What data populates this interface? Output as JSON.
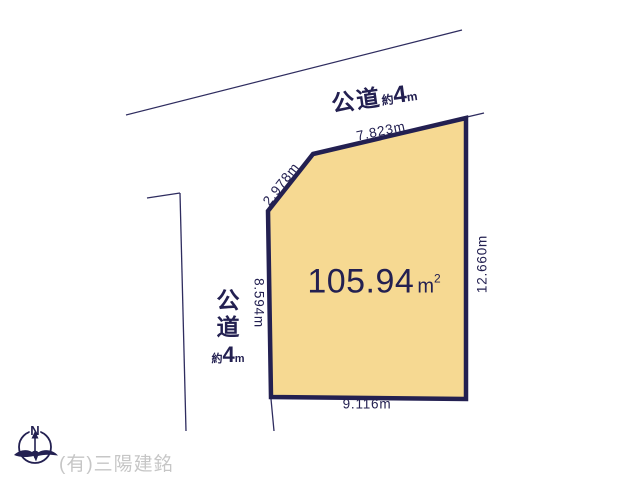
{
  "plot": {
    "area_value": "105.94",
    "area_unit": "m",
    "area_unit_sup": "2",
    "dim_top": "7.823m",
    "dim_diagonal": "2.978m",
    "dim_left": "8.594m",
    "dim_right": "12.660m",
    "dim_bottom": "9.116m"
  },
  "roads": {
    "top": {
      "name": "公道",
      "approx": "約",
      "width": "4",
      "unit": "m"
    },
    "left": {
      "char1": "公",
      "char2": "道",
      "approx": "約",
      "width": "4",
      "unit": "m"
    }
  },
  "compass": {
    "north": "N"
  },
  "footer": {
    "company": "(有)三陽建銘"
  },
  "colors": {
    "plot_fill": "#F6D992",
    "plot_border": "#232051",
    "line": "#2E2C5F",
    "text": "#232051",
    "company_text": "#C6C6C6",
    "background": "#FFFFFF"
  }
}
